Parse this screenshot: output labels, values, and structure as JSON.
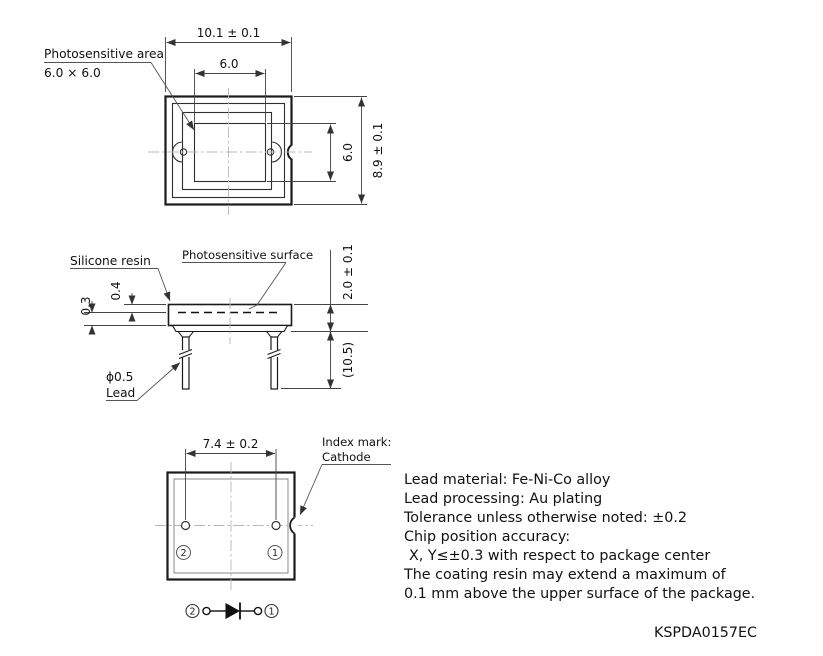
{
  "drawing_number": "KSPDA0157EC",
  "top_view": {
    "area_label_line1": "Photosensitive area",
    "area_label_line2": "6.0 × 6.0",
    "dim_width": "10.1 ± 0.1",
    "dim_inner_width": "6.0",
    "dim_inner_height": "6.0",
    "dim_height": "8.9 ± 0.1"
  },
  "side_view": {
    "label_resin": "Silicone resin",
    "label_surface": "Photosensitive surface",
    "dim_resin_thickness": "0.4",
    "dim_step": "0.3",
    "dim_body_height": "2.0 ± 0.1",
    "dim_lead_length": "(10.5)",
    "label_lead_dia": "ϕ0.5",
    "label_lead": "Lead"
  },
  "bottom_view": {
    "dim_lead_pitch": "7.4 ± 0.2",
    "index_label_line1": "Index mark:",
    "index_label_line2": "Cathode",
    "pin2": "2",
    "pin1": "1"
  },
  "circuit": {
    "pin2": "2",
    "pin1": "1"
  },
  "notes": {
    "lines": [
      "Lead material: Fe-Ni-Co alloy",
      "Lead processing: Au plating",
      "Tolerance unless otherwise noted: ±0.2",
      "Chip position accuracy:",
      "X, Y≤±0.3 with respect to package center",
      "The coating resin may extend a maximum of",
      "0.1 mm above the upper surface of the package."
    ]
  },
  "colors": {
    "line": "#1a1a1a",
    "dimension": "#444444",
    "centerline": "#b8b8b8",
    "background": "#ffffff"
  }
}
